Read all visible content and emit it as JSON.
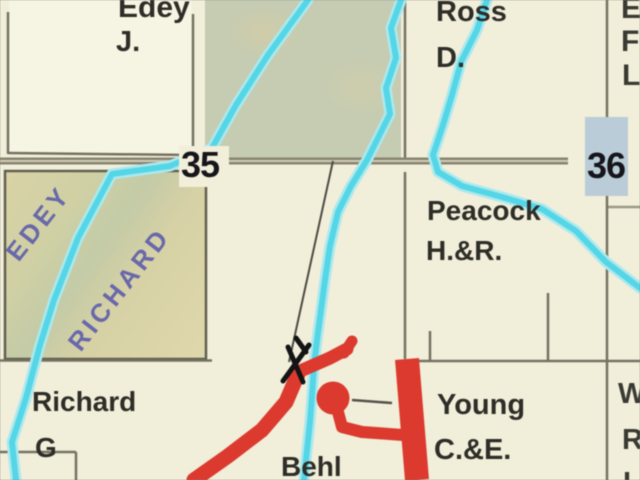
{
  "map": {
    "type_note": "rural plat / landowner township map section view",
    "section_numbers": {
      "s35": "35",
      "s36": "36"
    },
    "owners": {
      "edey": {
        "surname": "Edey",
        "initials": "J."
      },
      "ross": {
        "surname": "Ross",
        "initials": "D."
      },
      "peacock": {
        "surname": "Peacock",
        "initials": "H.&R."
      },
      "richard": {
        "surname": "Richard",
        "initials": "G"
      },
      "young": {
        "surname": "Young",
        "initials": "C.&E."
      },
      "behl": {
        "surname": "Behl"
      }
    },
    "watermarks": {
      "edey": "EDEY",
      "richard": "RICHARD"
    },
    "edge_text": {
      "top_right": [
        "E",
        "F",
        "L"
      ],
      "bottom_right": [
        "W",
        "R",
        "L"
      ]
    },
    "colors": {
      "background": "#f1eeda",
      "parcel_light": "#f6f4e2",
      "woodlot_green": "#c5ccb2",
      "parcel_tan": "#d9d3a7",
      "stream_cyan": "#55d6e6",
      "stream_halo": "#ace9ee",
      "road_red": "#dc3a2e",
      "road_gray": "#87846f",
      "boundary_gray": "#6f6c5b",
      "section36_highlight": "#b9ccd8",
      "watermark_blue": "#5d5dab",
      "label_dark": "#2e2d27",
      "section_number_black": "#15151a"
    }
  }
}
